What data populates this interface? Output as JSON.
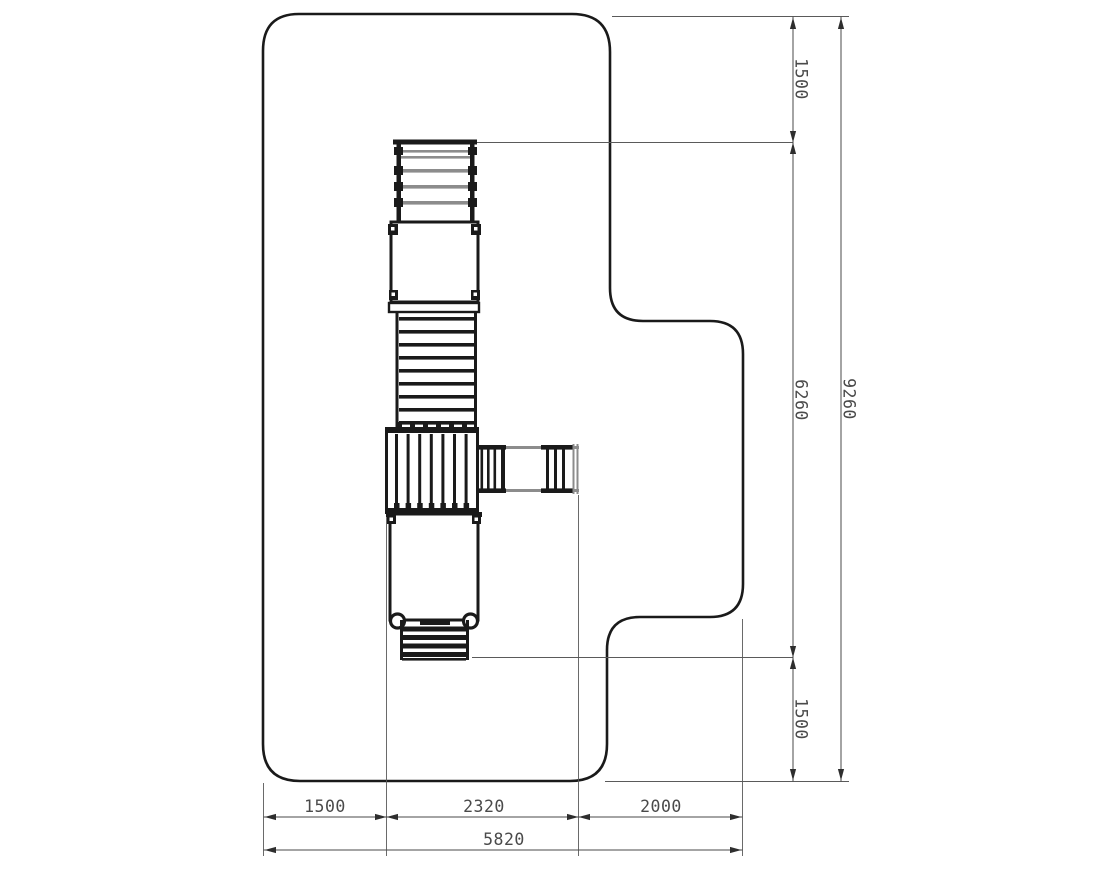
{
  "dimensions": {
    "right_chain": {
      "top": "1500",
      "middle": "6260",
      "bottom": "1500"
    },
    "right_overall": "9260",
    "bottom_chain": {
      "left": "1500",
      "middle": "2320",
      "right": "2000"
    },
    "bottom_overall": "5820"
  },
  "colors": {
    "outline": "#1a1a1a",
    "gray_rail": "#8c8c8c",
    "dimension_line": "#4a4a4a",
    "label_text": "#4a4a4a",
    "background": "#ffffff"
  }
}
